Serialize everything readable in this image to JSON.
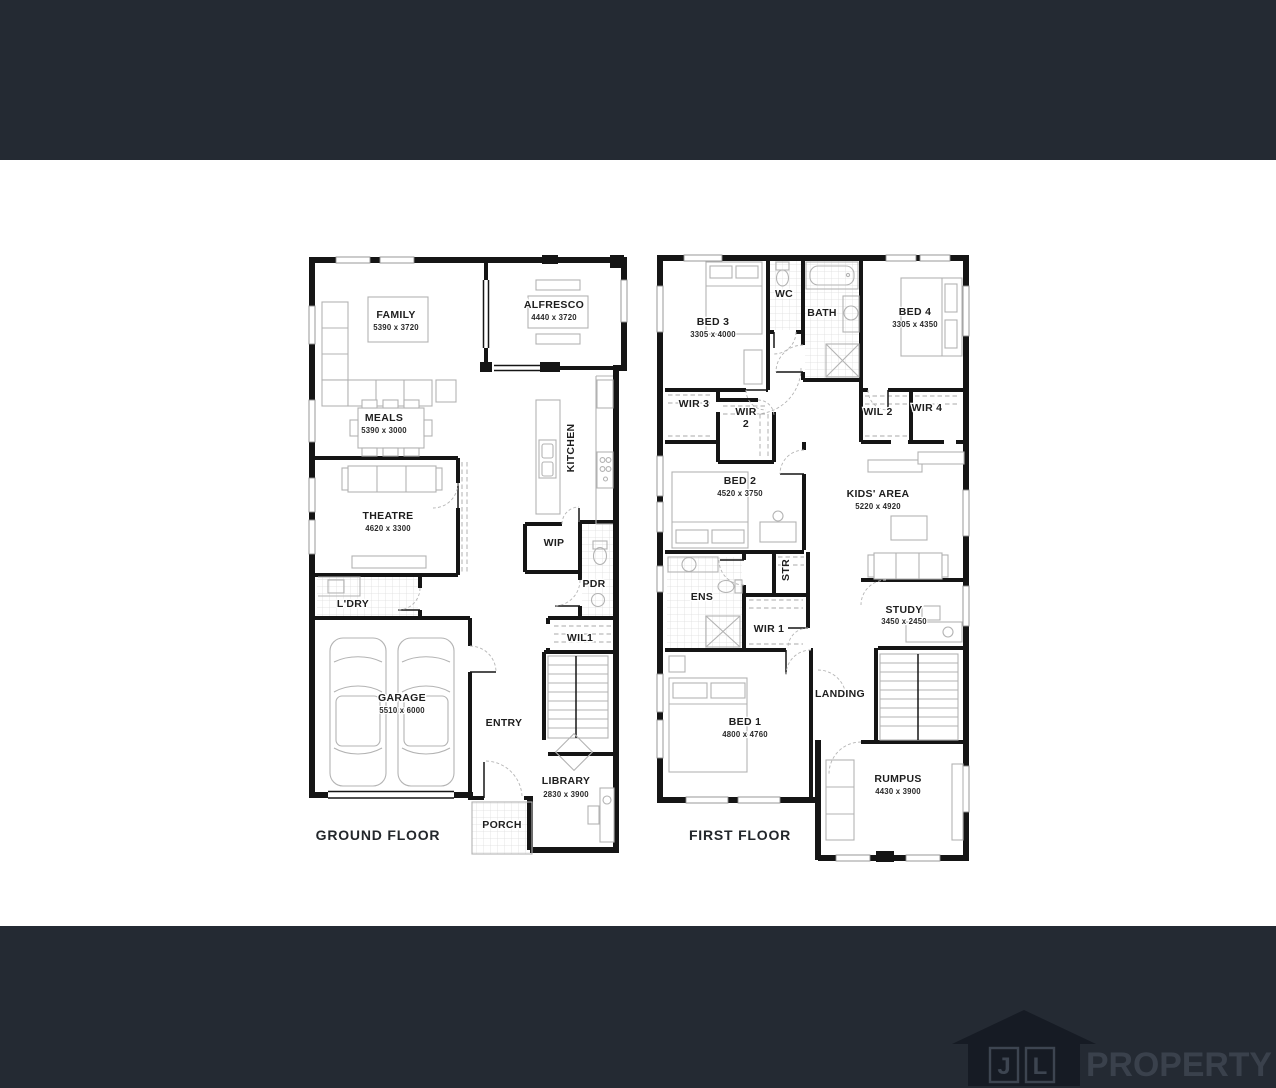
{
  "frame": {
    "bar_color": "#242a33",
    "canvas_color": "#ffffff"
  },
  "plans": {
    "ground": {
      "title": "GROUND FLOOR",
      "rooms": {
        "family": {
          "name": "FAMILY",
          "dims": "5390 x 3720"
        },
        "alfresco": {
          "name": "ALFRESCO",
          "dims": "4440 x 3720"
        },
        "meals": {
          "name": "MEALS",
          "dims": "5390 x 3000"
        },
        "kitchen": {
          "name": "KITCHEN"
        },
        "theatre": {
          "name": "THEATRE",
          "dims": "4620 x 3300"
        },
        "wip": {
          "name": "WIP"
        },
        "pdr": {
          "name": "PDR"
        },
        "ldry": {
          "name": "L'DRY"
        },
        "wil1": {
          "name": "WIL1"
        },
        "garage": {
          "name": "GARAGE",
          "dims": "5510 x 6000"
        },
        "entry": {
          "name": "ENTRY"
        },
        "library": {
          "name": "LIBRARY",
          "dims": "2830 x 3900"
        },
        "porch": {
          "name": "PORCH"
        }
      }
    },
    "first": {
      "title": "FIRST FLOOR",
      "rooms": {
        "bed3": {
          "name": "BED 3",
          "dims": "3305 x 4000"
        },
        "wc": {
          "name": "WC"
        },
        "bath": {
          "name": "BATH"
        },
        "bed4": {
          "name": "BED 4",
          "dims": "3305 x 4350"
        },
        "wir3": {
          "name": "WIR 3"
        },
        "wir2": {
          "line1": "WIR",
          "line2": "2"
        },
        "wil2": {
          "name": "WIL 2"
        },
        "wir4": {
          "name": "WIR 4"
        },
        "bed2": {
          "name": "BED 2",
          "dims": "4520 x 3750"
        },
        "kids": {
          "name": "KIDS' AREA",
          "dims": "5220 x 4920"
        },
        "str": {
          "name": "STR"
        },
        "ens": {
          "name": "ENS"
        },
        "wir1": {
          "name": "WIR 1"
        },
        "study": {
          "name": "STUDY",
          "dims": "3450 x 2450"
        },
        "landing": {
          "name": "LANDING"
        },
        "bed1": {
          "name": "BED 1",
          "dims": "4800 x 4760"
        },
        "rumpus": {
          "name": "RUMPUS",
          "dims": "4430 x 3900"
        }
      }
    }
  },
  "logo": {
    "letter_j": "J",
    "letter_l": "L",
    "word": "PROPERTY"
  }
}
